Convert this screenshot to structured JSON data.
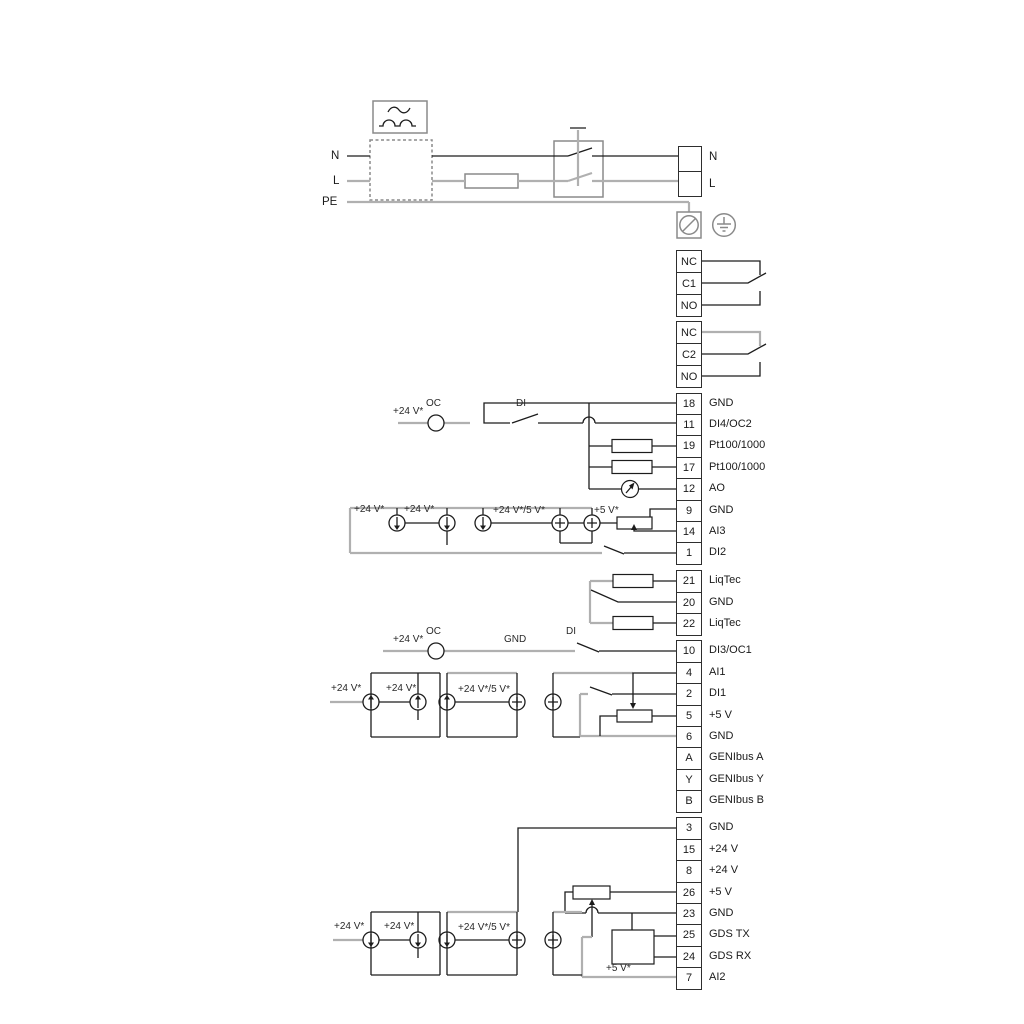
{
  "power": {
    "input_labels": [
      "N",
      "L",
      "PE"
    ],
    "output_labels": [
      "N",
      "L"
    ]
  },
  "relays": [
    {
      "terminals": [
        "NC",
        "C1",
        "NO"
      ]
    },
    {
      "terminals": [
        "NC",
        "C2",
        "NO"
      ]
    }
  ],
  "terminal_groups": [
    [
      {
        "num": "18",
        "label": "GND"
      },
      {
        "num": "11",
        "label": "DI4/OC2"
      },
      {
        "num": "19",
        "label": "Pt100/1000"
      },
      {
        "num": "17",
        "label": "Pt100/1000"
      },
      {
        "num": "12",
        "label": "AO"
      },
      {
        "num": "9",
        "label": "GND"
      },
      {
        "num": "14",
        "label": "AI3"
      },
      {
        "num": "1",
        "label": "DI2"
      }
    ],
    [
      {
        "num": "21",
        "label": "LiqTec"
      },
      {
        "num": "20",
        "label": "GND"
      },
      {
        "num": "22",
        "label": "LiqTec"
      }
    ],
    [
      {
        "num": "10",
        "label": "DI3/OC1"
      },
      {
        "num": "4",
        "label": "AI1"
      },
      {
        "num": "2",
        "label": "DI1"
      },
      {
        "num": "5",
        "label": "+5 V"
      },
      {
        "num": "6",
        "label": "GND"
      },
      {
        "num": "A",
        "label": "GENIbus A"
      },
      {
        "num": "Y",
        "label": "GENIbus Y"
      },
      {
        "num": "B",
        "label": "GENIbus B"
      }
    ],
    [
      {
        "num": "3",
        "label": "GND"
      },
      {
        "num": "15",
        "label": "+24 V"
      },
      {
        "num": "8",
        "label": "+24 V"
      },
      {
        "num": "26",
        "label": "+5 V"
      },
      {
        "num": "23",
        "label": "GND"
      },
      {
        "num": "25",
        "label": "GDS TX"
      },
      {
        "num": "24",
        "label": "GDS RX"
      },
      {
        "num": "7",
        "label": "AI2"
      }
    ]
  ],
  "annotations": {
    "plus24": "+24 V*",
    "oc": "OC",
    "di": "DI",
    "gnd": "GND",
    "plus24_5": "+24 V*/5 V*",
    "plus5": "+5 V*"
  },
  "colors": {
    "wire_black": "#1c1c1c",
    "wire_gray": "#b0b0b0",
    "outline_gray": "#8a8a8a",
    "text": "#1a1a1a"
  }
}
